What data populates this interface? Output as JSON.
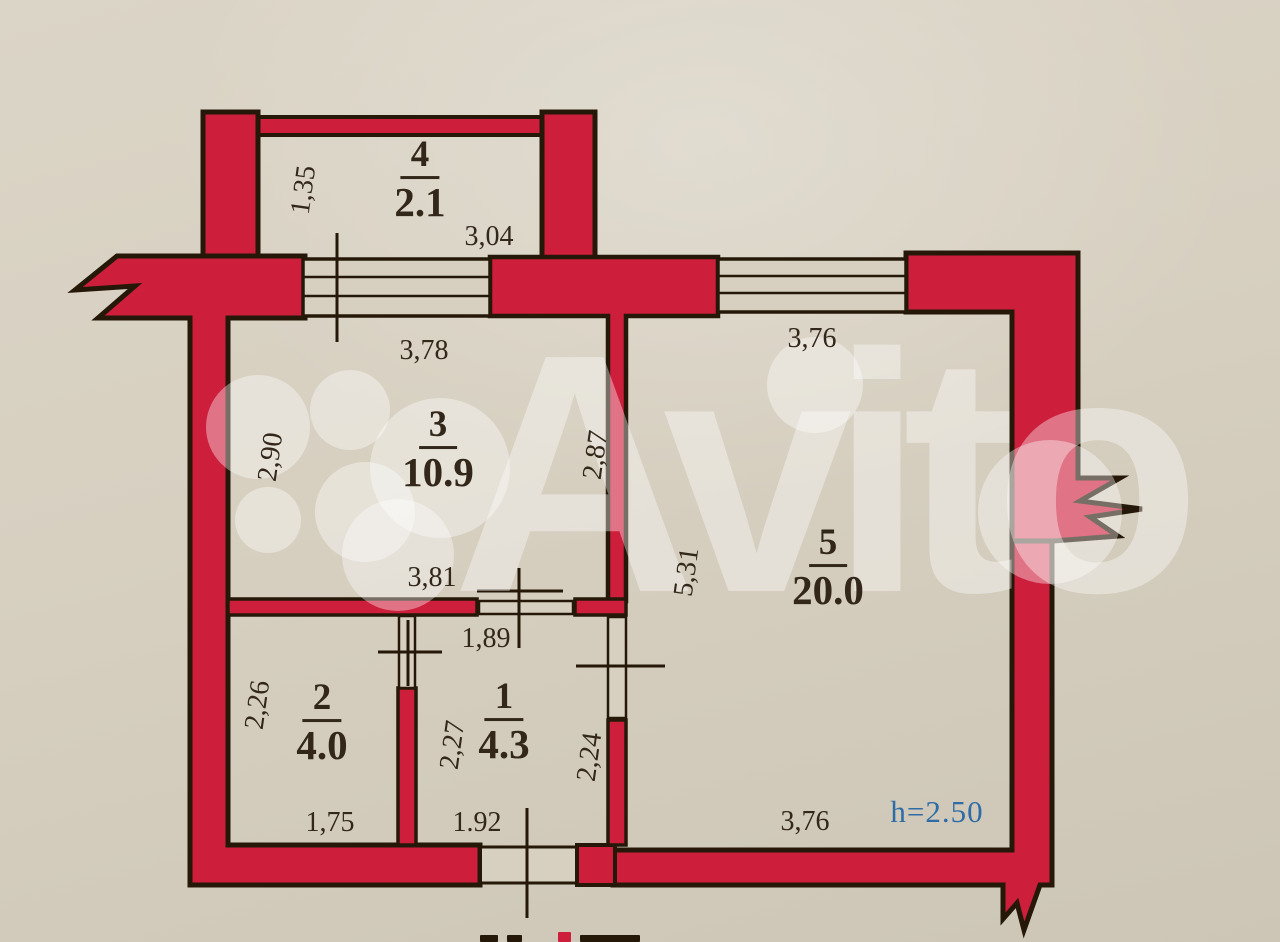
{
  "colors": {
    "paper": "#d7d0c1",
    "paper_dark": "#c8c1b1",
    "wall": "#cd1e3b",
    "ink": "#251808",
    "text": "#33271a",
    "blue": "#2e6ca6"
  },
  "watermark": {
    "brand": "Avito"
  },
  "rooms": {
    "r1": {
      "number": "1",
      "area": "4.3"
    },
    "r2": {
      "number": "2",
      "area": "4.0"
    },
    "r3": {
      "number": "3",
      "area": "10.9"
    },
    "r4": {
      "number": "4",
      "area": "2.1"
    },
    "r5": {
      "number": "5",
      "area": "20.0"
    }
  },
  "dims": {
    "balcony_depth": "1,35",
    "balcony_width": "3,04",
    "room3_top": "3,78",
    "room3_left": "2,90",
    "room3_right": "2,87",
    "room3_bottom": "3,81",
    "room5_top": "3,76",
    "room5_left": "5,31",
    "room5_bottom": "3,76",
    "hall_top": "1,89",
    "room2_left": "2,26",
    "room2_bottom": "1,75",
    "room1_left": "2,27",
    "room1_right": "2,24",
    "entry_bottom": "1.92",
    "ceiling_height": "h=2.50"
  }
}
